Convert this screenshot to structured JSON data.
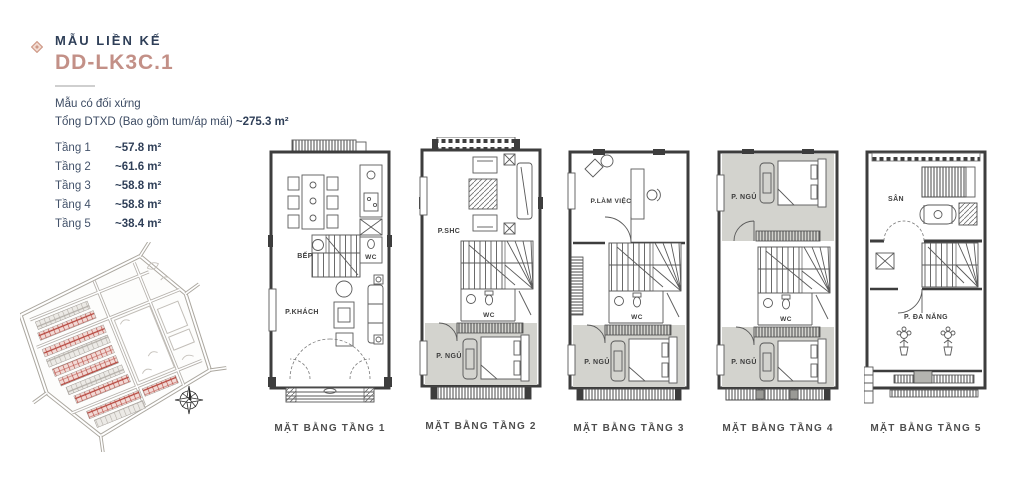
{
  "header": {
    "category": "MẪU LIỀN KẾ",
    "model": "DD-LK3C.1",
    "note": "Mẫu có đối xứng",
    "total_label": "Tổng DTXD (Bao gồm tum/áp mái)",
    "total_value": "~275.3 m²"
  },
  "area_table": {
    "rows": [
      {
        "floor": "Tầng 1",
        "area": "~57.8 m²"
      },
      {
        "floor": "Tầng 2",
        "area": "~61.6 m²"
      },
      {
        "floor": "Tầng 3",
        "area": "~58.8 m²"
      },
      {
        "floor": "Tầng 4",
        "area": "~58.8 m²"
      },
      {
        "floor": "Tầng 5",
        "area": "~38.4 m²"
      }
    ]
  },
  "plans": [
    {
      "caption": "MẶT BẰNG TẦNG 1",
      "rooms": {
        "dining": "BẾP + ĂN",
        "wc": "WC",
        "living": "P.KHÁCH"
      }
    },
    {
      "caption": "MẶT BẰNG TẦNG 2",
      "rooms": {
        "family": "P.SHC",
        "wc": "WC",
        "bedroom": "P. NGỦ"
      }
    },
    {
      "caption": "MẶT BẰNG TẦNG 3",
      "rooms": {
        "office": "P.LÀM VIỆC",
        "wc": "WC",
        "bedroom": "P. NGỦ"
      }
    },
    {
      "caption": "MẶT BẰNG TẦNG 4",
      "rooms": {
        "bedroom_top": "P. NGỦ",
        "wc": "WC",
        "bedroom_bottom": "P. NGỦ"
      }
    },
    {
      "caption": "MẶT BẰNG TẦNG 5",
      "rooms": {
        "terrace": "SÂN",
        "multi": "P. ĐA NĂNG"
      }
    }
  ],
  "colors": {
    "accent_rose": "#c39087",
    "title_navy": "#2f3f58",
    "bedroom_gray": "#d3d3ce",
    "plot_red": "#b5453c"
  }
}
